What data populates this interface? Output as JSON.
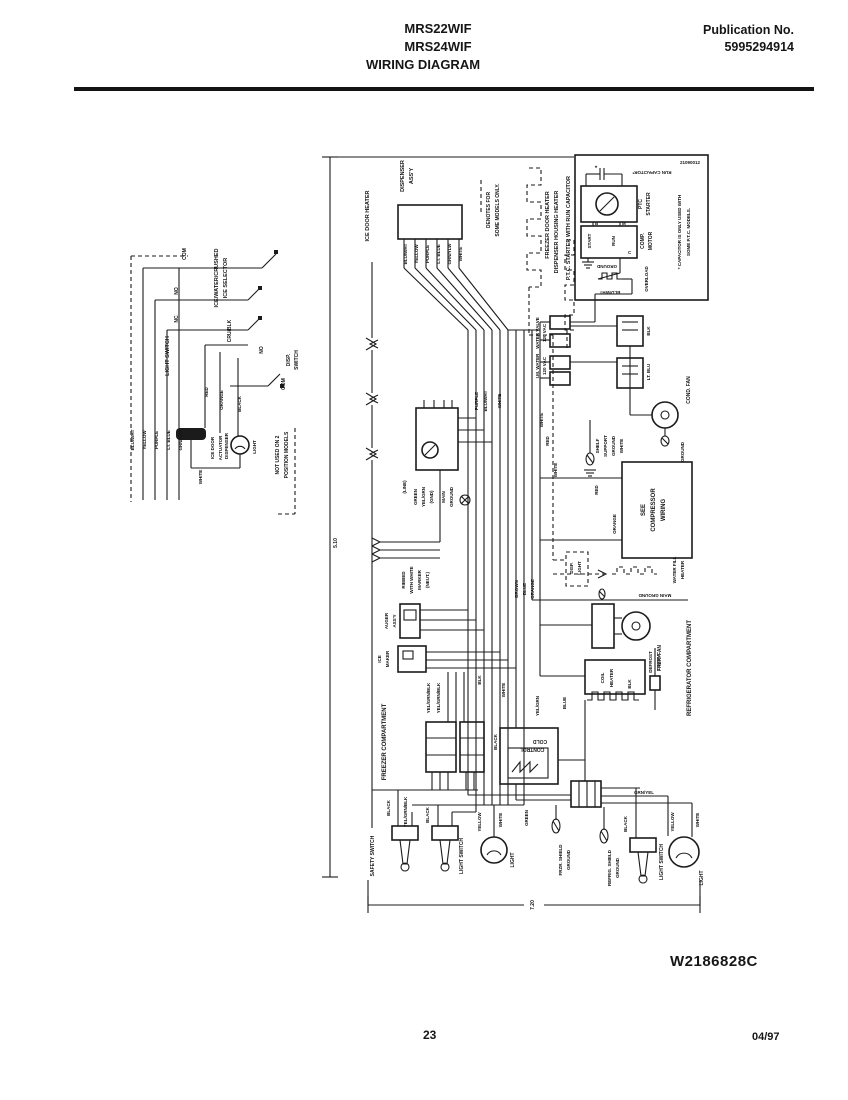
{
  "header": {
    "model1": "MRS22WIF",
    "model2": "MRS24WIF",
    "title": "WIRING DIAGRAM",
    "pub_label": "Publication No.",
    "pub_number": "5995294914"
  },
  "footer": {
    "doc_number": "W2186828C",
    "page_number": "23",
    "date": "04/97"
  },
  "dims": {
    "height": "5.10",
    "width": "7.20"
  },
  "labels": {
    "selector_l1": "ICE/WATER/CRUSHED",
    "selector_l2": "ICE SELECTOR",
    "com_1": "COM",
    "no_1": "NO",
    "nc_1": "NC",
    "light_switch_inset": "LIGHT SWITCH",
    "cru_blk": "CRU/BLK",
    "no_2": "NO",
    "com_2": "COM",
    "disp_sw_1": "DISP.",
    "disp_sw_2": "SWITCH",
    "w_blu_wht": "BLU/WHT",
    "w_yellow": "YELLOW",
    "w_purple": "PURPLE",
    "w_lt_blue": "LT. BLUE",
    "w_grn_ylw": "GRN/YLW",
    "w_white": "WHITE",
    "red_1": "RED",
    "orange_1": "ORANGE",
    "black_1": "BLACK",
    "ice_door_1": "ICE DOOR",
    "ice_door_2": "ACTUATOR",
    "disp_bulb_1": "DISPENSER",
    "disp_bulb_2": "LIGHT",
    "not_used_1": "NOT USED ON 2",
    "not_used_2": "POSITION MODELS",
    "ice_door_heater": "ICE DOOR HEATER",
    "disp_assy_1": "DISPENSER",
    "disp_assy_2": "ASS'Y",
    "p_blu_wht": "BLU/WHT",
    "p_yellow": "YELLOW",
    "p_purple": "PURPLE",
    "p_lt_blue": "LT. BLUE",
    "p_grn_ylw": "GRN/YLW",
    "p_white": "WHITE",
    "denotes_1": "DENOTES FOR",
    "denotes_2": "SOME MODELS ONLY.",
    "freezer_door_heater": "FREEZER DOOR HEATER",
    "dispenser_housing_heater": "DISPENSER HOUSING HEATER",
    "ptc_title": "P.T.C. STARTER WITH RUN CAPACITOR",
    "run_capacitor": "RUN CAPACITOR*",
    "asterisk": "*",
    "ptc_1": "PTC",
    "ptc_2": "STARTER",
    "comp_1": "COMP.",
    "comp_2": "MOTOR",
    "start_l": "START",
    "run_l": "RUN",
    "b_l": "B",
    "m_l": "M",
    "c_l": "C",
    "ground_ptc": "GROUND",
    "overload": "OVERLOAD",
    "blu_wht_ptc": "BLU/WHT",
    "cap_note_1": "* CAPACITOR IS ONLY USED WITH",
    "cap_note_2": "SOME P.T.C. MODELS.",
    "part_no": "21090012",
    "water_valve_1": "WATER VALVE",
    "water_valve_2": "120 VAC",
    "im_water_1": "I.M. WATER",
    "im_water_2": "120 VAC",
    "wire_c": "BLK",
    "wire_d": "LT. BLU",
    "cond_fan": "COND. FAN",
    "purple_2": "PURPLE",
    "blu_wht_2": "BLU/WHT",
    "white_2": "WHITE",
    "white_3": "WHITE",
    "red_2": "RED",
    "white_5": "WHITE",
    "line_l": "(LINE)",
    "green_1": "GREEN",
    "yel_grn_1": "YEL/GRN",
    "gnd_l": "(GND)",
    "main_1": "MAIN",
    "ground_2": "GROUND",
    "ribbed_1": "RIBBED",
    "ribbed_2": "WITH WHITE",
    "ribbed_3": "MARKER",
    "ribbed_4": "(NEUT.)",
    "shelf_1": "SHELF",
    "shelf_2": "SUPPORT",
    "shelf_3": "GROUND",
    "white_10": "WHITE",
    "see_1": "SEE",
    "see_2": "COMPRESSOR",
    "see_3": "WIRING",
    "orange_2": "ORANGE",
    "red_3": "RED",
    "ground_4": "GROUND",
    "brown": "BROWN",
    "blue_1": "BLUE",
    "orange_3": "ORANGE",
    "auger_1": "AUGER",
    "auger_2": "ASS'Y",
    "ice_maker_1": "ICE",
    "ice_maker_2": "MAKER",
    "ygb_1": "YEL/GRN/BLK",
    "ygb_2": "YEL/GRN/BLK",
    "freezer_compartment": "FREEZER COMPARTMENT",
    "refrigerator_compartment": "REFRIGERATOR COMPARTMENT",
    "blk_2": "BLK",
    "white_6": "WHITE",
    "disp_light_1": "DISP.",
    "disp_light_2": "LIGHT",
    "water_fill_1": "WATER FILL",
    "water_fill_2": "HEATER",
    "main_ground": "MAIN GROUND",
    "frzr_fan": "FRZR. FAN",
    "coil_1": "COIL",
    "coil_2": "HEATER",
    "blk_3": "BLK",
    "defrost_therm_1": "DEFROST",
    "defrost_therm_2": "THERM.",
    "cold_1": "COLD",
    "cold_2": "CONTROL",
    "black_2": "BLACK",
    "yel_grn_2": "YEL/GRN",
    "blue_2": "BLUE",
    "safety_switch": "SAFETY SWITCH",
    "black_3": "BLACK",
    "ygb_3": "YEL/GRN/BLK",
    "light_switch_frz": "LIGHT SWITCH",
    "black_4": "BLACK",
    "yellow_2": "YELLOW",
    "white_8": "WHITE",
    "light_1": "LIGHT",
    "green_2": "GREEN",
    "frzr_shield_1": "FRZR. SHIELD",
    "frzr_shield_2": "GROUND",
    "grn_yel_2": "GRN/YEL",
    "refrig_shield_1": "REFRIG. SHIELD",
    "refrig_shield_2": "GROUND",
    "black_5": "BLACK",
    "light_switch_ref": "LIGHT SWITCH",
    "yellow_3": "YELLOW",
    "white_9": "WHITE",
    "light_2": "LIGHT"
  }
}
